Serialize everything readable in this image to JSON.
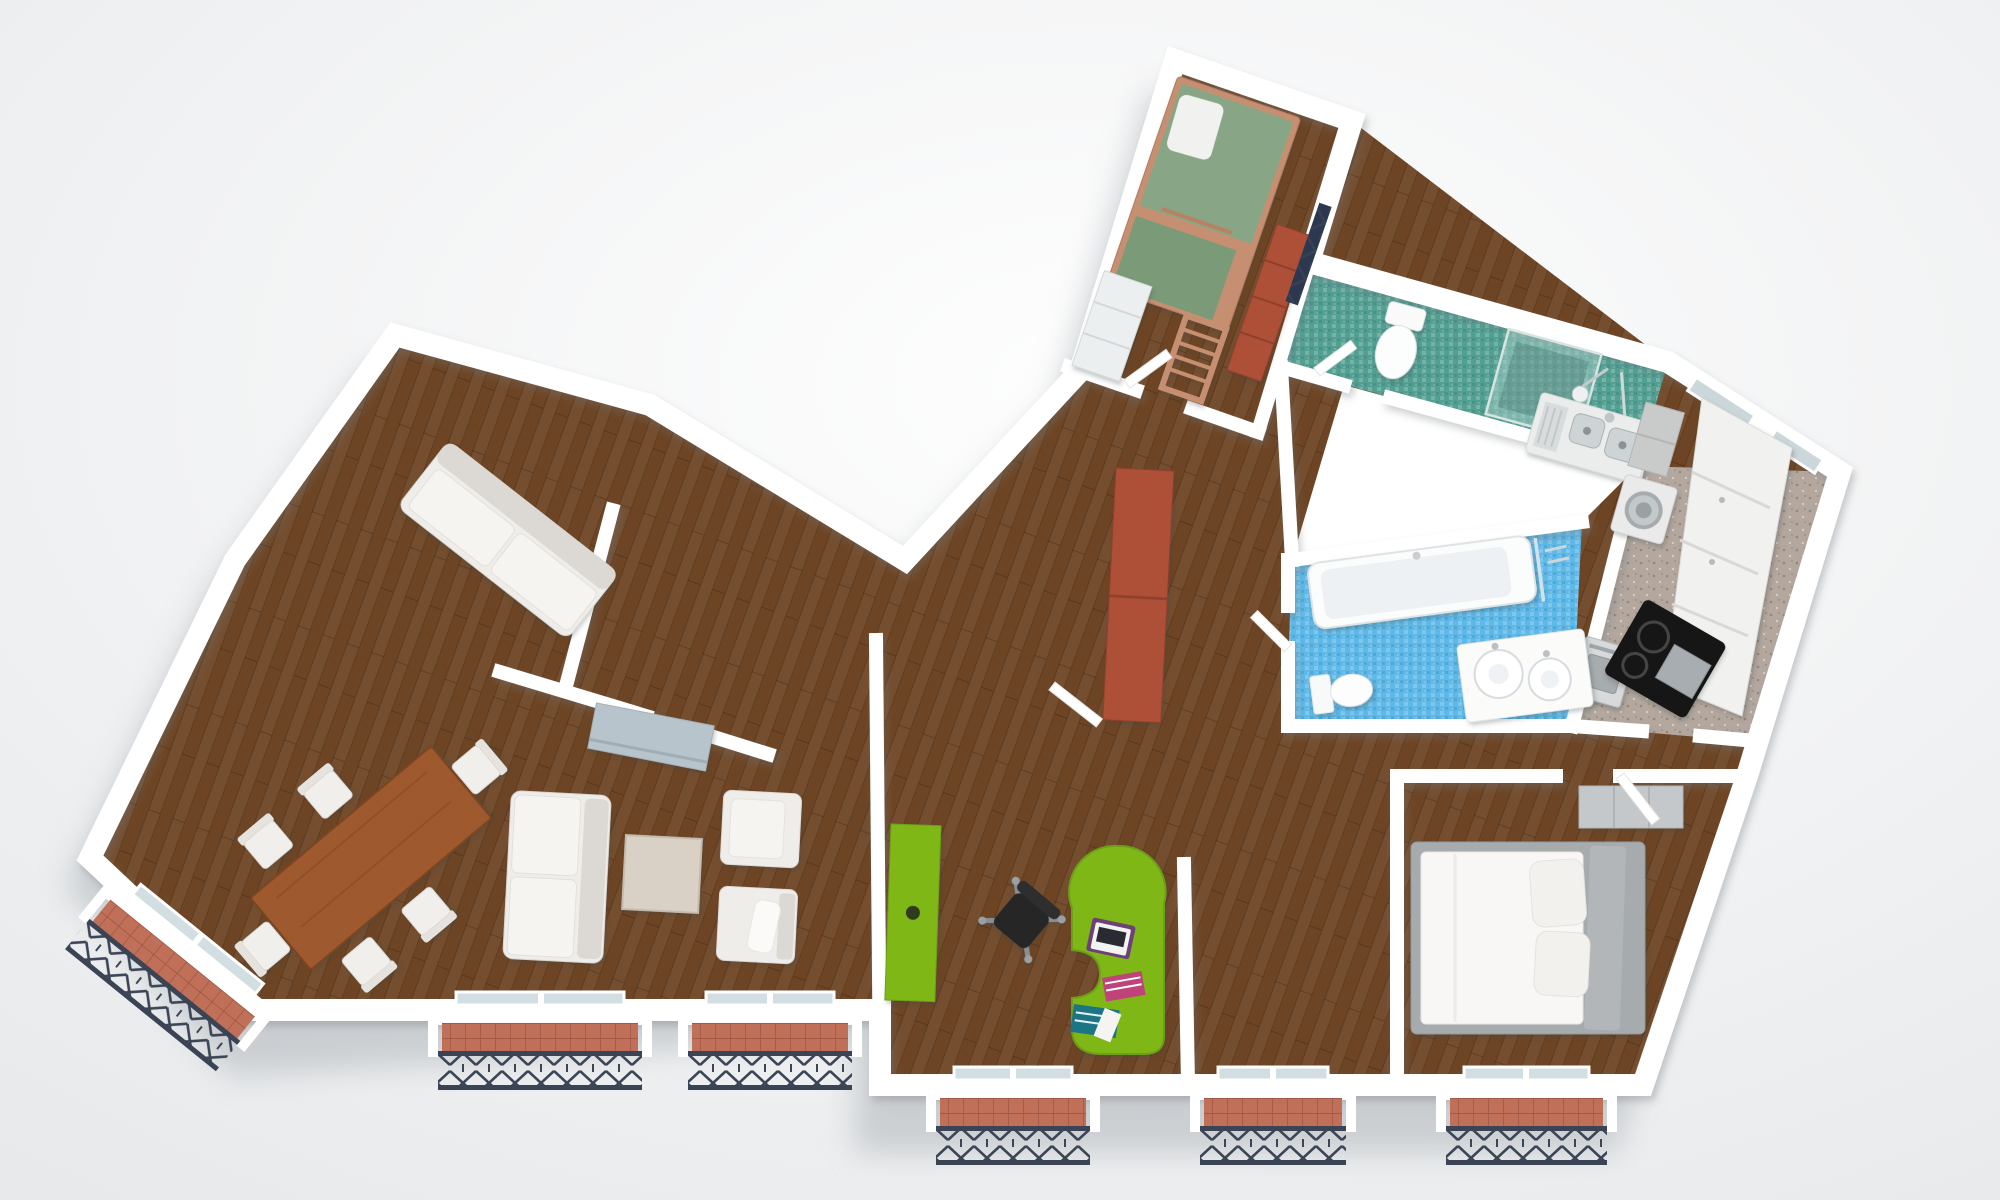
{
  "scene": {
    "description": "Top-down 3D architectural render of an apartment floor plan on a soft white background",
    "view": "bird's-eye cutaway, white sliced walls, soft drop shadow under the building"
  },
  "palette": {
    "background_top": "#fefefe",
    "background_edge": "#e7e9eb",
    "plan_shadow": "#a9afb4",
    "wall_white": "#ffffff",
    "wall_edge": "#e9ebec",
    "wood_floor": "#6e4524",
    "teal_tile": "#53a093",
    "blue_tile": "#5fb9e8",
    "kitchen_floor": "#b3a79e",
    "balcony_tile": "#c07059",
    "iron_railing": "#3a4454",
    "furniture_green": "#7fb717",
    "wardrobe_red": "#ae5038",
    "dining_table_wood": "#9e5a2e",
    "bunk_wood": "#c68f72",
    "mattress_green": "#88a685",
    "mattress_green_dark": "#7a9a78",
    "sofa_white": "#efedea",
    "sofa_shade": "#dcd8d3",
    "bed_frame_gray": "#a6abae",
    "sideboard_blue": "#b7c4cb",
    "chair_black": "#262626",
    "laptop_purple": "#6d3f7a",
    "book_pink": "#bf4379",
    "book_teal": "#1a7485",
    "steel_sink": "#ced4d6",
    "glass_pane": "#d3dee3"
  },
  "rooms": [
    {
      "id": "living-dining",
      "label": "Living / dining room",
      "floor": "dark walnut parquet",
      "furniture": [
        "dining table",
        "six white dining chairs",
        "three-seat white sofa",
        "two white armchairs",
        "square coffee table",
        "blue-grey sideboard",
        "two-seat sofa in window nook"
      ]
    },
    {
      "id": "home-office",
      "label": "Home office",
      "floor": "dark walnut parquet",
      "furniture": [
        "lime-green curved desk",
        "laptop",
        "books",
        "black swivel chair",
        "lime-green tall cabinet"
      ]
    },
    {
      "id": "hallway",
      "label": "Hallway",
      "floor": "dark walnut parquet",
      "furniture": [
        "terracotta tall wardrobe",
        "open white doors"
      ]
    },
    {
      "id": "kids-bedroom",
      "label": "Kids bedroom",
      "floor": "dark walnut parquet",
      "furniture": [
        "wooden bunk bed with green mattresses",
        "ladder",
        "white dresser",
        "terracotta shelf unit",
        "dark juliet window grille"
      ]
    },
    {
      "id": "shower-room",
      "label": "Shower room / WC",
      "floor": "teal mosaic tile",
      "furniture": [
        "toilet",
        "glass walk-in shower",
        "shower fitting"
      ]
    },
    {
      "id": "kitchen",
      "label": "Kitchen",
      "floor": "beige speckled tile",
      "furniture": [
        "stainless double sink",
        "washing machine",
        "oven",
        "black cooktop",
        "white cabinet run",
        "wall windows"
      ]
    },
    {
      "id": "bathroom",
      "label": "Bathroom",
      "floor": "light-blue mosaic tile",
      "furniture": [
        "bathtub",
        "vanity with two round glass basins",
        "toilet",
        "glass screen"
      ]
    },
    {
      "id": "master-bedroom",
      "label": "Master bedroom",
      "floor": "walnut parquet",
      "furniture": [
        "double bed with white duvet",
        "two pillows",
        "grey bed frame and headboard",
        "built-in closet"
      ]
    }
  ],
  "exterior": {
    "window_bays": "five french-window bays with terracotta sills and dark wrought-iron X-lattice juliet railings along the bottom facade",
    "left_balcony": "angled juliet balcony with wrought-iron railing on the lower-left facade"
  }
}
